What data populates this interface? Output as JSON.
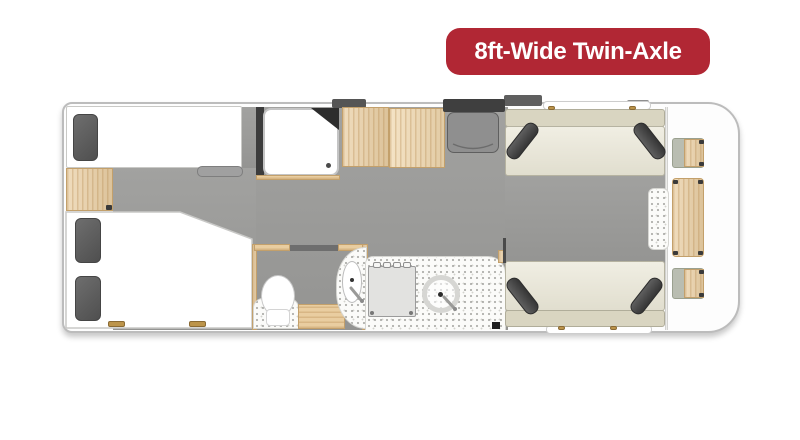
{
  "badge": {
    "label": "8ft-Wide Twin-Axle",
    "background": "#b12734",
    "text_color": "#ffffff"
  },
  "palette": {
    "floor_gray": "#9c9c9a",
    "wood": "#eacfa4",
    "sofa_cream": "#eae7d7",
    "sofa_backrest": "#d9d5c1",
    "cushion_dark": "#434343",
    "pillow_dark": "#5a5a5a",
    "body_outline": "#bcbcbc",
    "counter_speckle": "#fbfbf9",
    "front_shelf_gray": "#b9bdb1",
    "entrance_dark": "#3f3f3f"
  },
  "floorplan": {
    "type": "caravan-layout",
    "features": [
      "single-bed",
      "wardrobe",
      "double-bed",
      "bedside-shelf",
      "shower",
      "washroom-toilet",
      "corner-basin",
      "washroom-step",
      "kitchen-hob",
      "kitchen-sink",
      "kitchen-counter",
      "entrance-door-mat",
      "lounge-sofa-top",
      "lounge-sofa-bottom",
      "lounge-table",
      "front-table",
      "front-corner-shelves",
      "windows"
    ]
  }
}
